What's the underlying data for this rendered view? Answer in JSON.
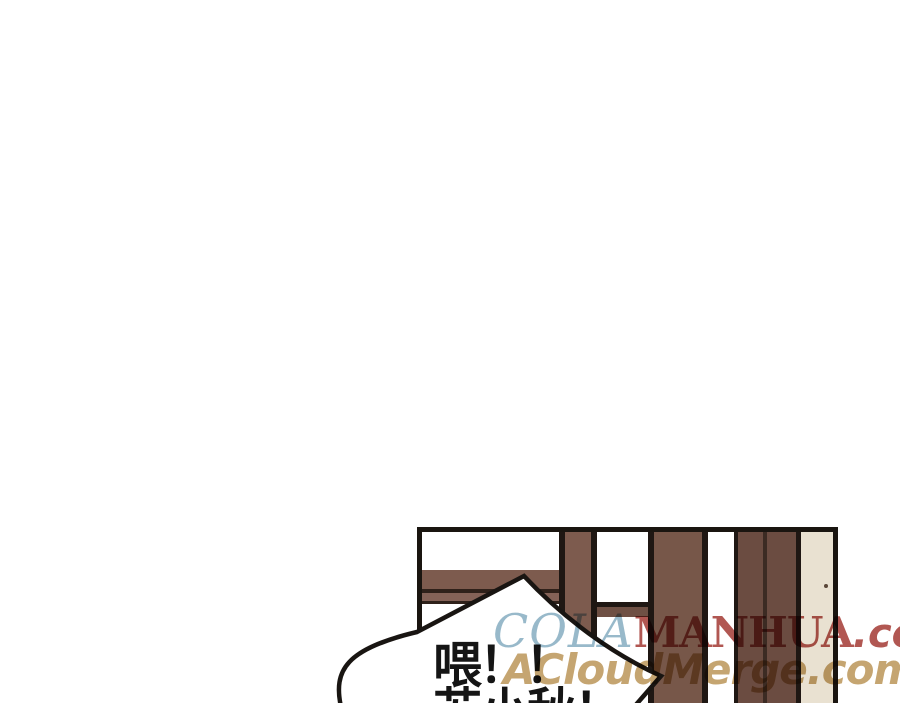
{
  "page": {
    "width": 900,
    "height": 703,
    "background": "#ffffff"
  },
  "panel": {
    "border_color": "#1a1510",
    "background": "#ffffff",
    "window": {
      "frame_color": "#7d5b4e",
      "frame_dark_line_color": "#2f211a",
      "outline_color": "#1f1713",
      "post_color": "#775749",
      "plank_color": "#6b4c41",
      "plank_seam_color": "#3c2b23",
      "door_strip_color": "#e9e1d1"
    }
  },
  "speech_bubble": {
    "fill": "#ffffff",
    "stroke": "#191512",
    "text_color": "#151515",
    "line1": "喂！！",
    "line2": "苏小秋！"
  },
  "watermarks": {
    "site1": {
      "part1": "COLA",
      "part1_color": "#92b5c7",
      "part2": "MANHUA",
      "part3": ".com",
      "part2_color": "#ad4e48"
    },
    "site2": {
      "text": "ACloudMerge.com",
      "color": "#c2a069"
    }
  }
}
